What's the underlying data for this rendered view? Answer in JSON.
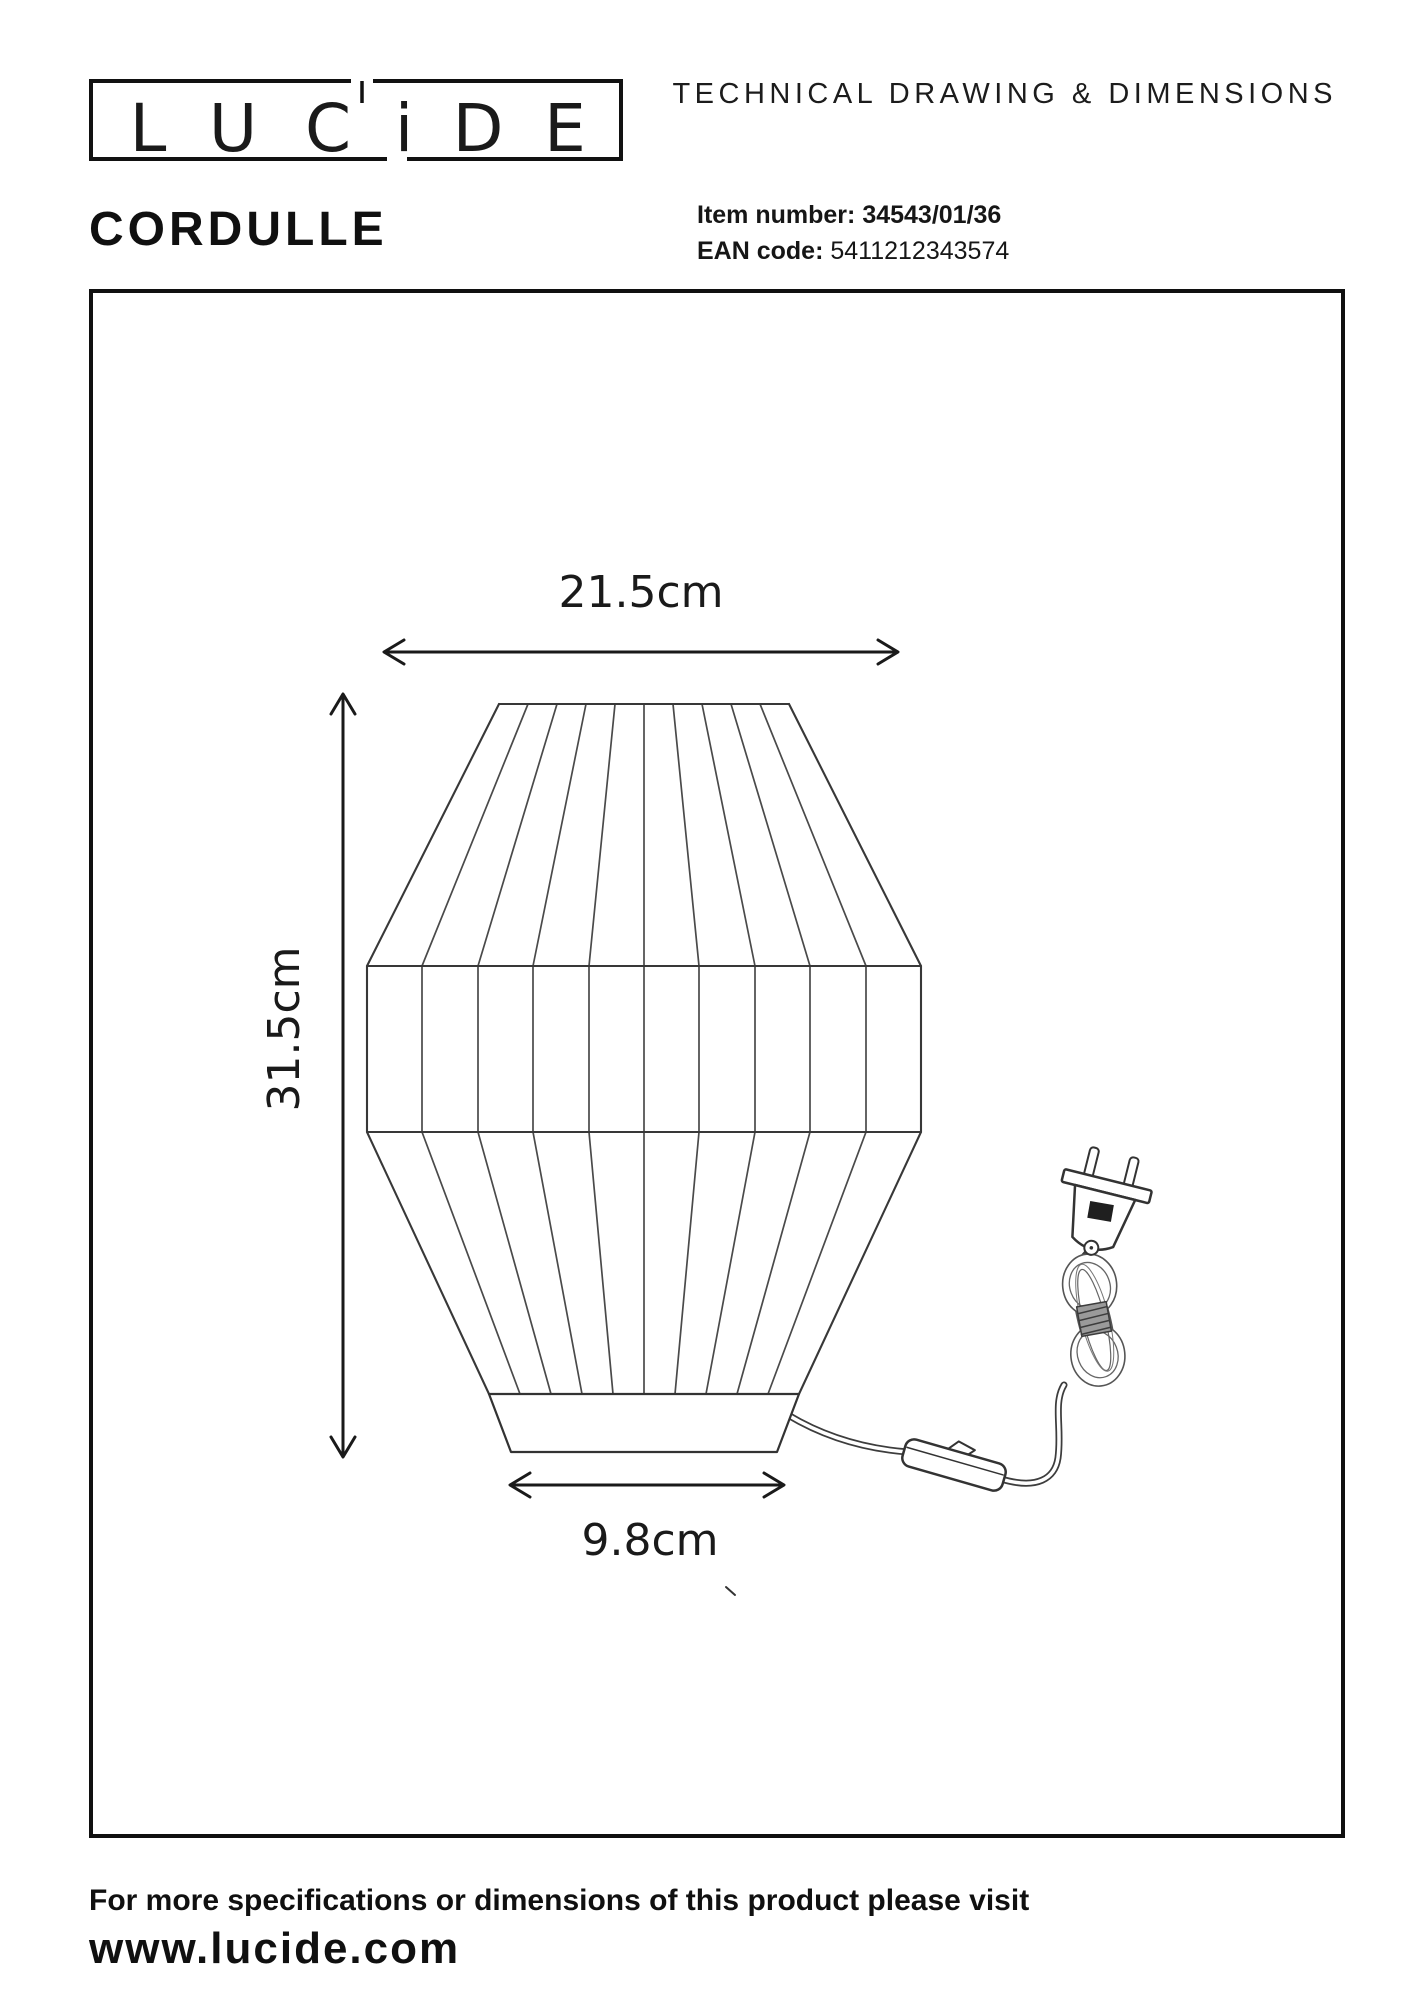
{
  "header": {
    "brand_letters": [
      "L",
      "U",
      "C",
      "i",
      "D",
      "E"
    ],
    "doc_title": "TECHNICAL DRAWING & DIMENSIONS",
    "product_name": "CORDULLE",
    "item_number_label": "Item number:",
    "item_number_value": "34543/01/36",
    "ean_label": "EAN code:",
    "ean_value": "5411212343574"
  },
  "drawing": {
    "dim_width": "21.5cm",
    "dim_height": "31.5cm",
    "dim_base": "9.8cm"
  },
  "footer": {
    "note": "For more specifications or dimensions of this product please visit",
    "url": "www.lucide.com"
  },
  "colors": {
    "ink": "#101010",
    "line": "#4a4a4a"
  }
}
